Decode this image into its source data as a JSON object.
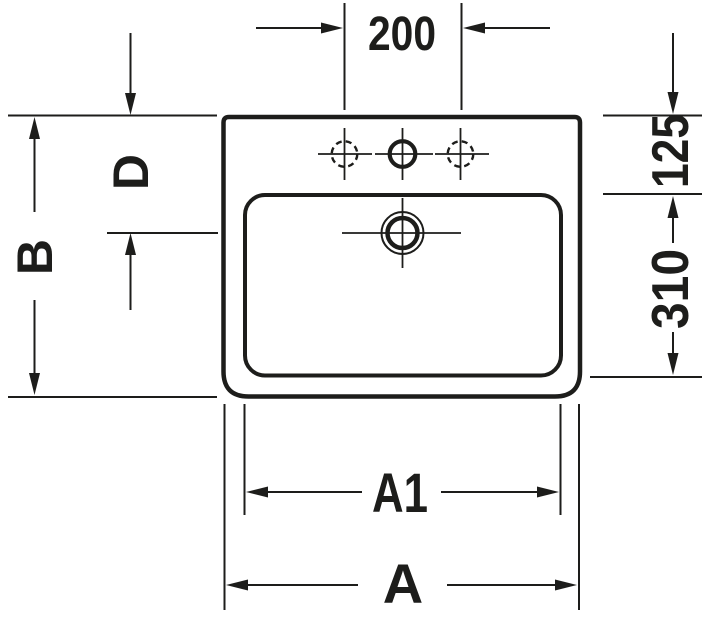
{
  "drawing": {
    "type": "technical-dimension-drawing",
    "subject": "washbasin top view",
    "colors": {
      "background": "#ffffff",
      "line": "#1d1d1b"
    },
    "labels": {
      "faucet_spacing": "200",
      "depth_total": "B",
      "drain_offset": "D",
      "rim_inset": "125",
      "bowl_depth": "310",
      "bowl_width": "A1",
      "overall_width": "A"
    }
  }
}
